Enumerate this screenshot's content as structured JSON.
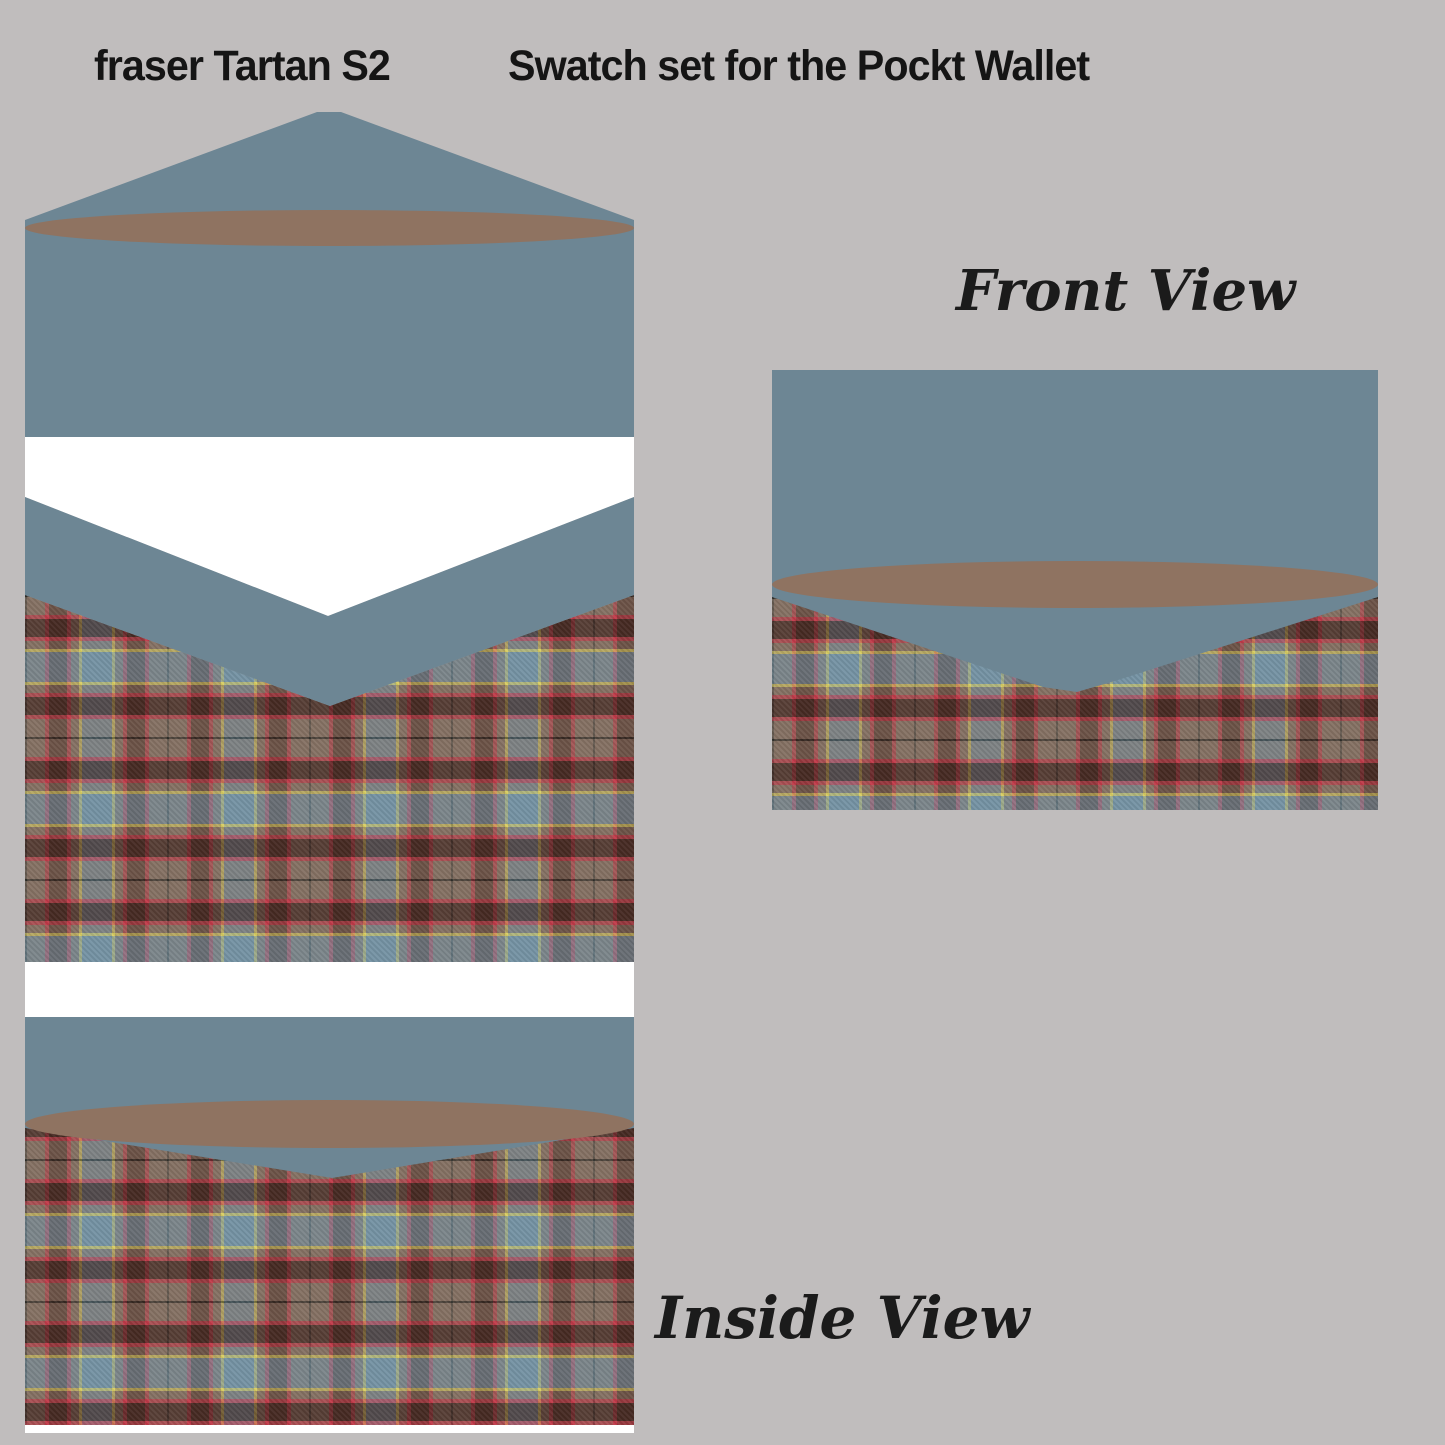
{
  "header": {
    "product_title": "fraser Tartan S2",
    "subtitle": "Swatch set for the Pockt Wallet"
  },
  "views": {
    "front": {
      "label": "Front View"
    },
    "inside": {
      "label": "Inside View"
    }
  },
  "materials": {
    "background_color": "#c0bdbd",
    "flap_color": "#6d8694",
    "snap_button_color": "#8f7361",
    "lining_color": "#ffffff",
    "tartan_palette": {
      "base_taupe": "#857163",
      "dark_brown": "#53342b",
      "red": "#c13a49",
      "yellow": "#d9ce62",
      "slate_blue": "#7593a4",
      "black_line": "#44423c"
    }
  }
}
